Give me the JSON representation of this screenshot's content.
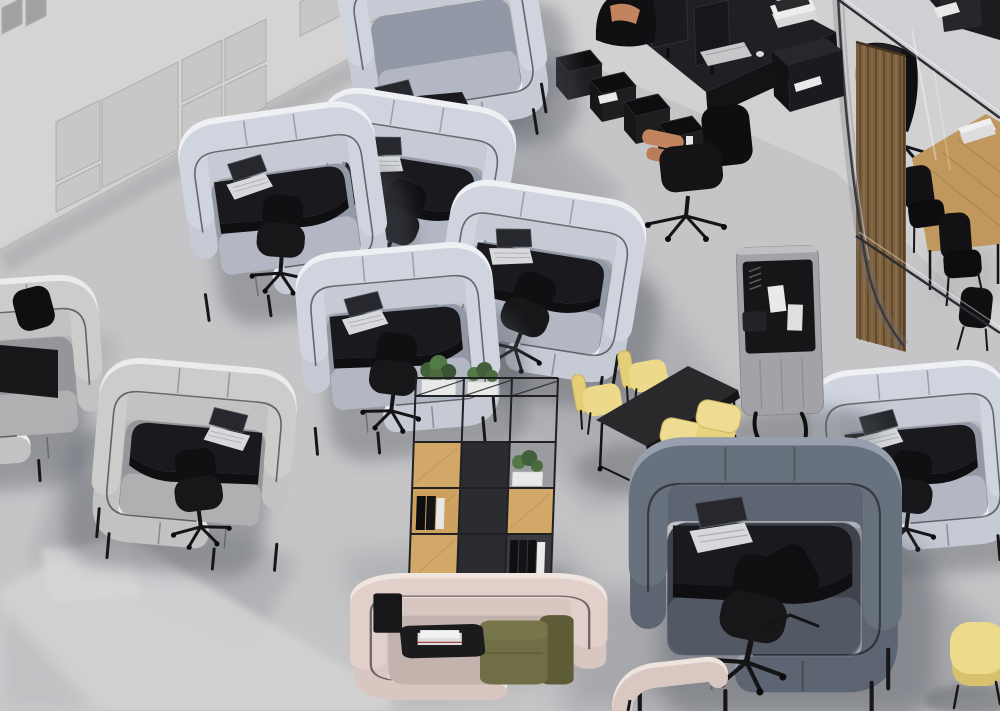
{
  "scene": {
    "description": "High-angle isometric 3D rendering of a modern open-plan office: acoustic focus pods with laptops, a black team desk station with two workers, a glass meeting room with wooden slat screen and oak table, an oak-and-steel shelving unit with plants, a black project table with yellow chairs, a mobile pinboard screen, a pink lounge pod with an olive sofa and a yellow pouf on a polished concrete floor.",
    "view": "top-down axonometric render",
    "no_visible_text": true
  },
  "palette": {
    "floor": "#c5c5c7",
    "floor_light": "#d1d1d2",
    "floor_shadow": "#a8a9ae",
    "wall": "#d5d4d2",
    "wall_panel": "#c8c7c5",
    "pod_light": "#c6cad5",
    "pod_warm": "#c2c2c2",
    "pod_navy": "#5d6572",
    "pod_pink": "#d8c6c0",
    "desk_black": "#1a1a1e",
    "chair_black": "#121215",
    "laptop_silver": "#d6d8da",
    "chair_yellow": "#ecda8a",
    "pouf_yellow": "#ecdb8b",
    "sofa_olive": "#6f6e44",
    "wood_table": "#c0975d",
    "oak_shelf": "#d2a868",
    "wood_slats": "#7a5f3e",
    "plant_green": "#4c6c40",
    "skin": "#c2845f",
    "glass_frame": "#2e2e32"
  },
  "objects": {
    "acoustic_wall_panels": {
      "count": 10
    },
    "focus_pods": {
      "light_gray_count": 6,
      "warm_gray_count": 2,
      "navy_count": 1,
      "pink_lounge_count": 2
    },
    "laptops_count": 8,
    "black_office_chairs_count": 13,
    "team_station": {
      "monitors": 2,
      "people": 2,
      "storage_cubes": 4,
      "binders": true,
      "books": true
    },
    "meeting_room": {
      "wood_table": 1,
      "black_chairs": 3,
      "person": 1,
      "wood_slat_screen": true,
      "glass_partition": true,
      "magazines": true
    },
    "shelving_unit": {
      "planters": 3,
      "oak_shelves": 5,
      "binder_groups": 2
    },
    "project_table": {
      "top_color": "black",
      "yellow_chairs": 4
    },
    "pinboard_screen": {
      "pinned_papers": 2
    },
    "yellow_pouf_count": 1,
    "sofa_count": 1
  }
}
